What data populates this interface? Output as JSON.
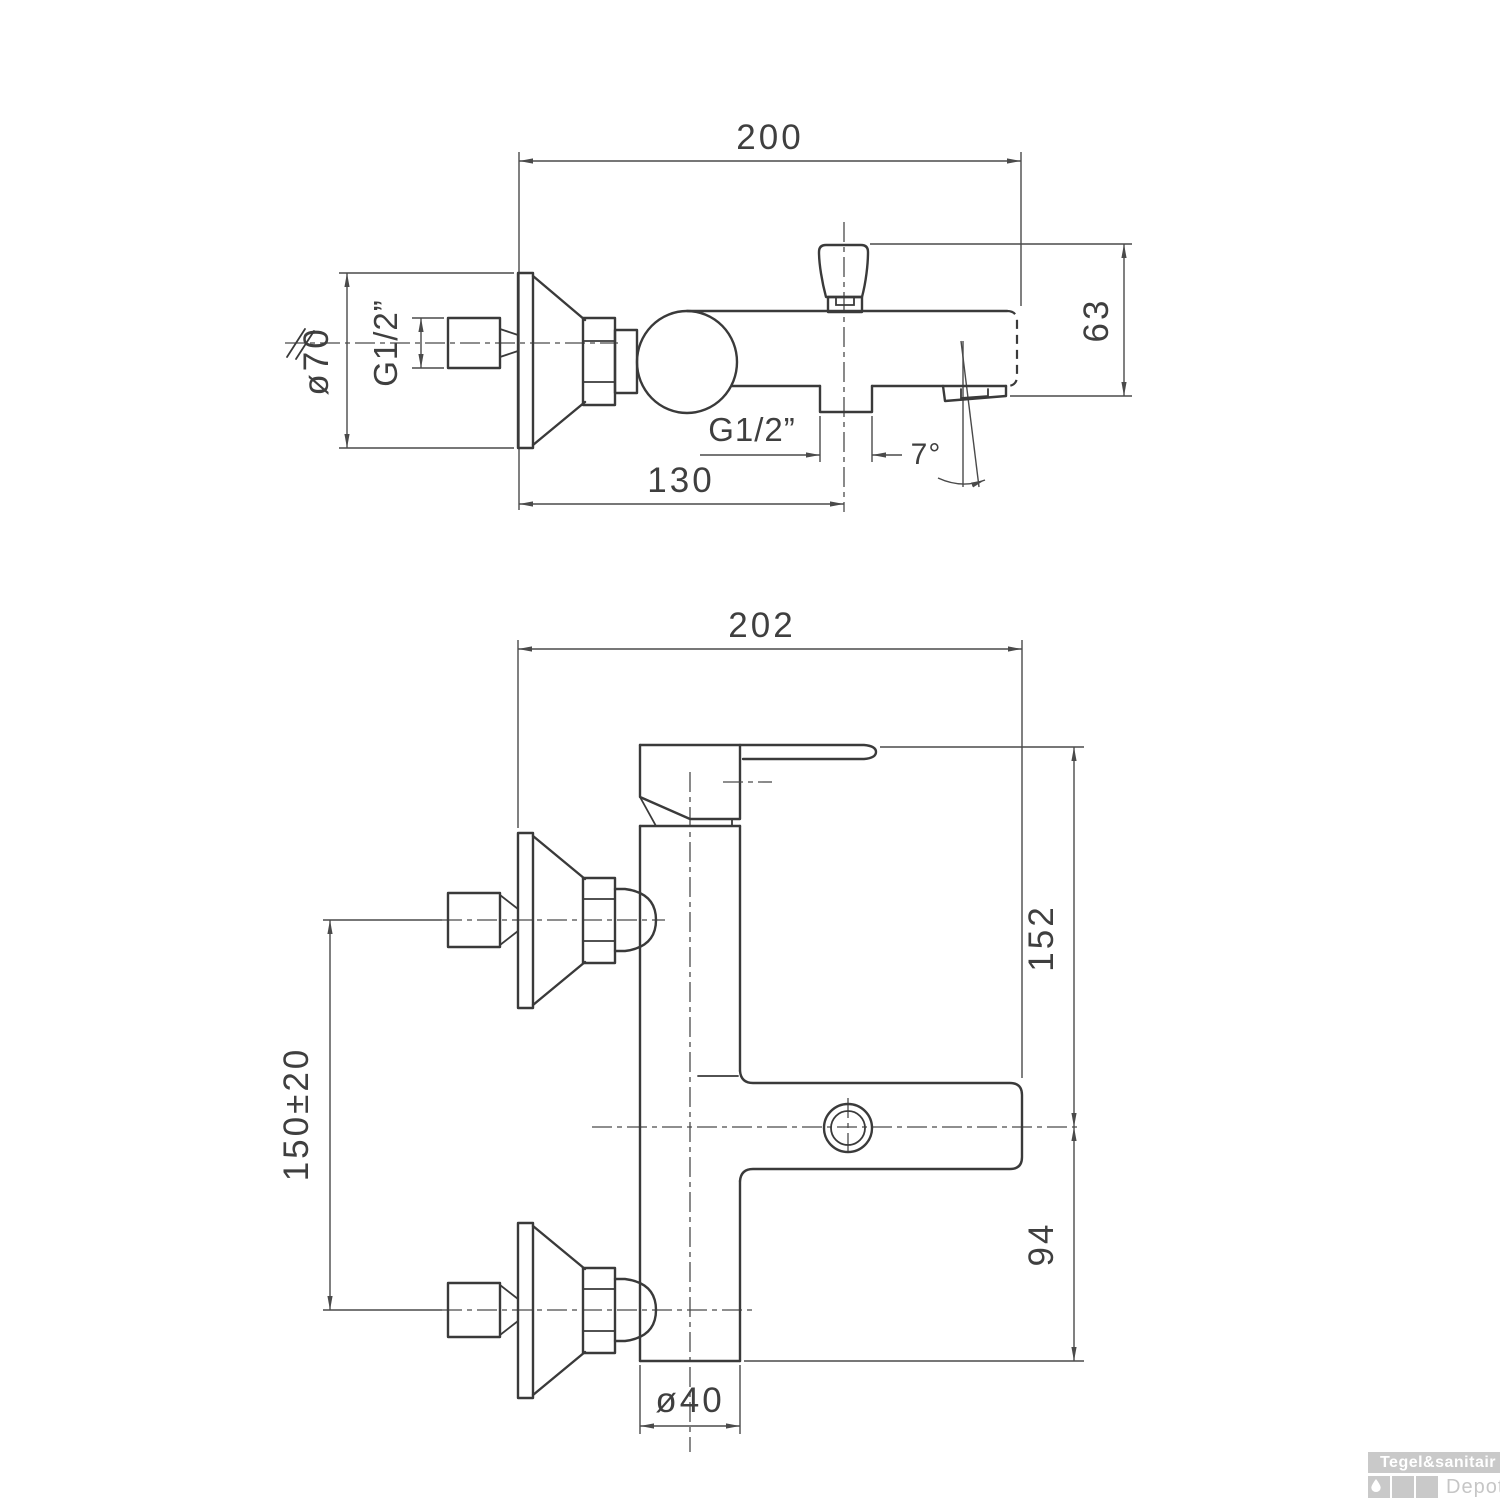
{
  "colors": {
    "line": "#3a3a3a",
    "text": "#3f3f3f",
    "wm-bg": "#c9c9c9",
    "wm-fg": "#ffffff",
    "wm-sub": "#c6c6c6"
  },
  "top_view": {
    "dim_total_length": "200",
    "dim_diverter_offset": "130",
    "dim_height": "63",
    "dim_flange_diameter": "ø70",
    "dim_wall_thread": "G1/2”",
    "dim_outlet_thread": "G1/2”",
    "dim_spout_angle": "7°"
  },
  "front_view": {
    "dim_total_length": "202",
    "dim_upper_height": "152",
    "dim_lower_height": "94",
    "dim_body_diameter": "ø40",
    "dim_inlet_spacing": "150±20"
  },
  "watermark": {
    "brand": "Tegel&sanitair",
    "sub": "Depot"
  }
}
